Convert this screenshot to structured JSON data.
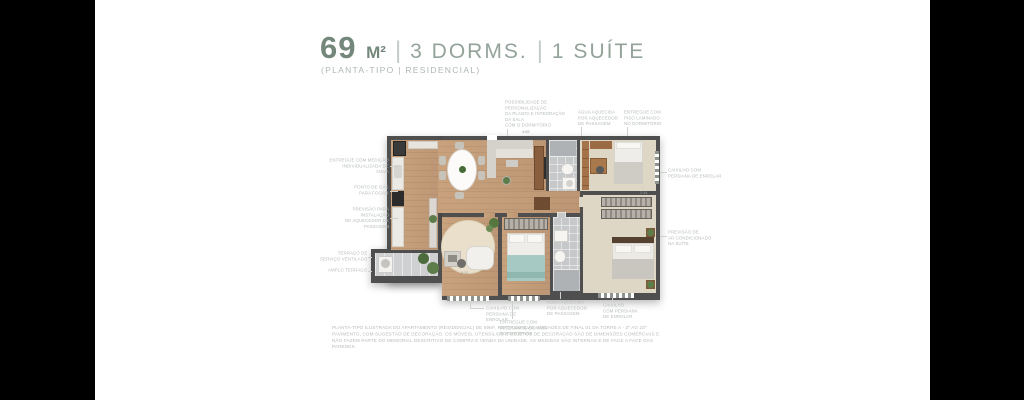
{
  "header": {
    "area_value": "69",
    "area_unit": "M²",
    "separator": "|",
    "dorms_label": "3 DORMS.",
    "suite_label": "1 SUÍTE",
    "subtitle": "(PLANTA-TIPO | RESIDENCIAL)"
  },
  "colors": {
    "title_strong": "#74877b",
    "title_light": "#93a39a",
    "annotation_text": "#b4bcb6",
    "wall": "#4f4f4f",
    "wood_floor": "#c49d78",
    "carpet_floor": "#ded7c5",
    "tile_floor": "#c6c8c9",
    "teal_accent": "#a7c9c3",
    "background_bars": "#000000",
    "panel": "#ffffff"
  },
  "annotations": {
    "left": [
      {
        "id": "water-metering",
        "text": "ENTREGUE COM MEDIÇÃO\nINDIVIDUALIZADA DE\nÁGUA"
      },
      {
        "id": "gas-point",
        "text": "PONTO DE GÁS\nPARA FOGÃO"
      },
      {
        "id": "heater-provision",
        "text": "PREVISÃO PARA\nINSTALAÇÃO\nDE AQUECEDOR DE\nPASSAGEM"
      },
      {
        "id": "service-terrace",
        "text": "TERRAÇO DE\nSERVIÇO VENTILADO"
      },
      {
        "id": "ample-terrace",
        "text": "AMPLO TERRAÇO"
      }
    ],
    "top": [
      {
        "id": "customization",
        "text": "POSSIBILIDADE DE\nPERSONALIZAÇÃO\nDA PLANTA E INTEGRAÇÃO\nDA SALA\nCOM O DORMITÓRIO"
      },
      {
        "id": "hot-water-top",
        "text": "ÁGUA AQUECIDA\nPOR AQUECEDOR\nDE PASSAGEM"
      },
      {
        "id": "laminate-top",
        "text": "ENTREGUE COM\nPISO LAMINADO\nNO DORMITÓRIO"
      }
    ],
    "right": [
      {
        "id": "shutter-right",
        "text": "CAIXILHO COM\nPERSIANA DE ENROLAR"
      },
      {
        "id": "ac-suite",
        "text": "PREVISÃO DE\nAR CONDICIONADO\nNA SUÍTE"
      }
    ],
    "bottom": [
      {
        "id": "shutter-bottom-left",
        "text": "CAIXILHO COM\nPERSIANA DE\nENROLAR"
      },
      {
        "id": "laminate-bottom",
        "text": "ENTREGUE COM\nPISO LAMINADO NOS\nDORMITÓRIOS"
      },
      {
        "id": "hot-water-bottom",
        "text": "ÁGUA AQUECIDA\nPOR AQUECEDOR\nDE PASSAGEM"
      },
      {
        "id": "shutter-bottom-right",
        "text": "CAIXILHO\nCOM PERSIANA\nDE ENROLAR"
      }
    ]
  },
  "dims": [
    "4.65",
    "5.21",
    "2.44"
  ],
  "disclaimer": "PLANTA-TIPO ILUSTRADA DO APARTAMENTO (RESIDENCIAL) DE 69M², REFERENTE ÀS UNIDADES DE FINAL 01 DA TORRE A - 2º AO 23º PAVIMENTO, COM SUGESTÃO DE DECORAÇÃO. OS MÓVEIS, UTENSÍLIOS E OBJETOS DE DECORAÇÃO SÃO DE DIMENSÕES COMERCIAIS E NÃO FAZEM PARTE DO MEMORIAL DESCRITIVO DE COMPRA E VENDA DA UNIDADE. AS MEDIDAS SÃO INTERNAS E DE FACE A FACE DAS PAREDES."
}
